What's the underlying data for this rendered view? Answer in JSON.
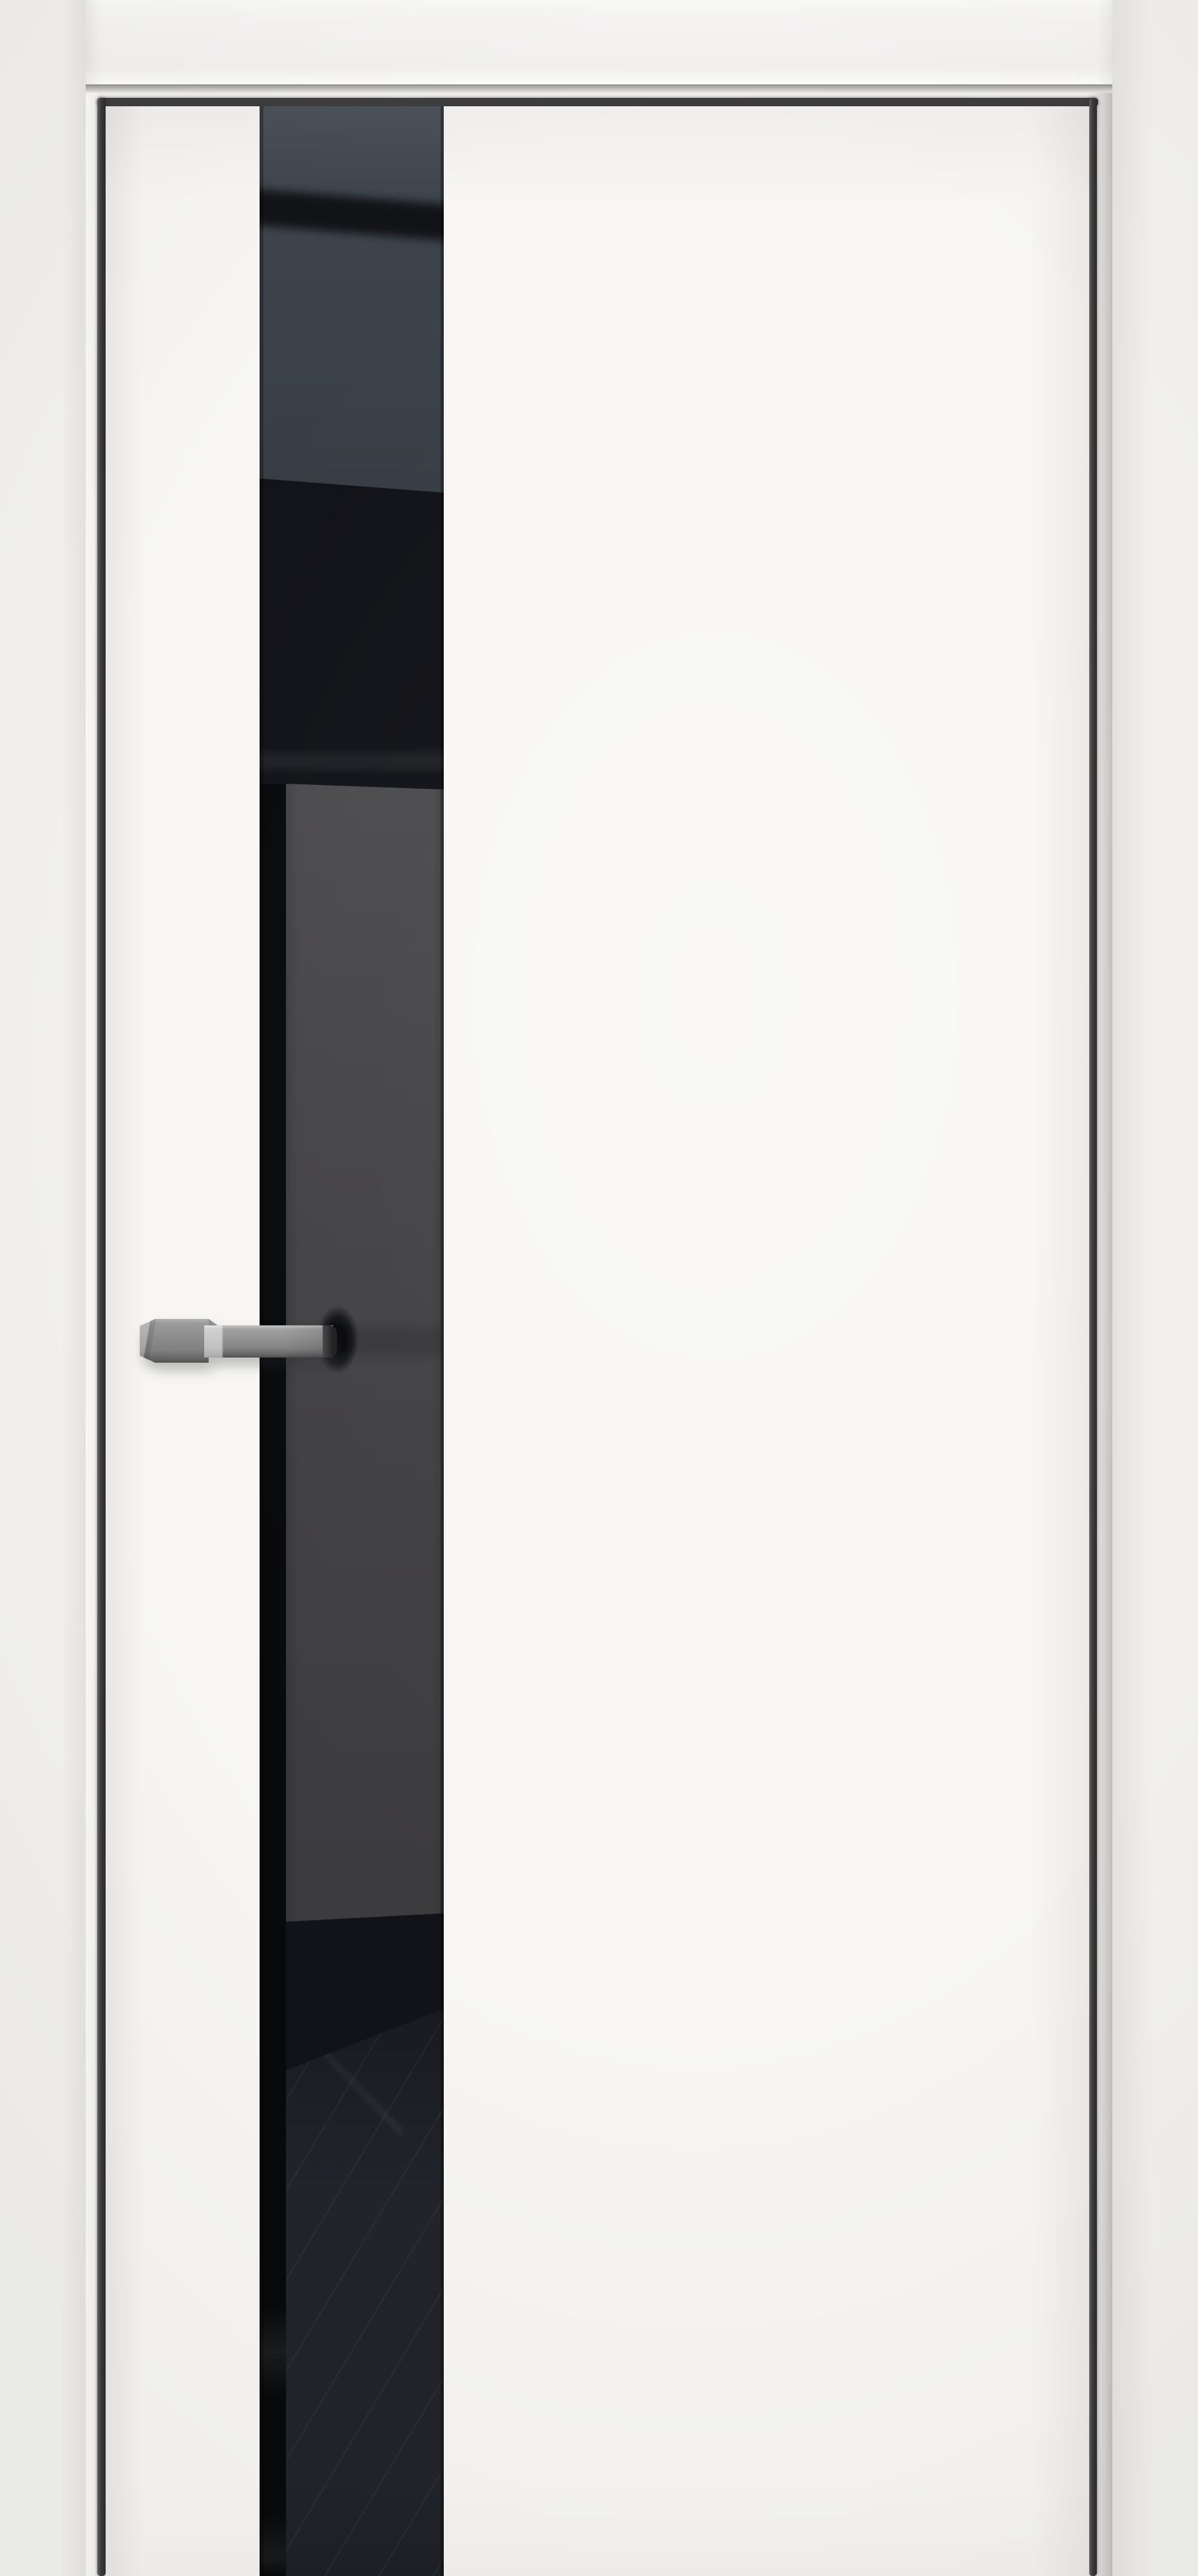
{
  "palette": {
    "wall": "#f1f0ee",
    "frame_casing": "#f5f4f3",
    "frame_reveal": "#efeeec",
    "door_gap_dark": "#3d3d3f",
    "door_leaf_white": "#f7f6f4",
    "glass_black": "#121318",
    "glass_top_slate": "#3e444c",
    "glass_panel_gray": "#434245",
    "glass_bottom_gray": "#21252b",
    "handle_gray": "#8d8d8d",
    "handle_tip_dark": "#323234"
  }
}
